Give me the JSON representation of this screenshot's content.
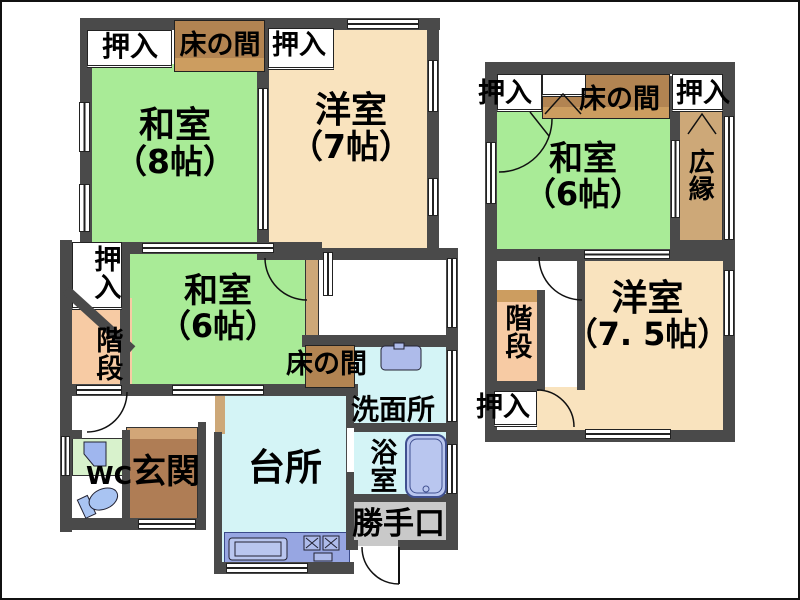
{
  "colors": {
    "wall": "#4A4A4A",
    "tatami_green": "#A9EB97",
    "western_beige": "#F9E3BE",
    "water_cyan": "#D4F4F6",
    "tokonoma_brown_dark": "#B28452",
    "tokonoma_brown_light": "#CC9D60",
    "genkan_brown": "#AF7D55",
    "stairs_peach": "#F7CBA4",
    "veranda_tan": "#CDA878",
    "backdoor_gray": "#C9C9C9",
    "counter_blue": "#97A6E2",
    "fixture_blue": "#B9C6EF"
  },
  "floor1": {
    "closet_top_left": "押入",
    "tokonoma_top": "床の間",
    "closet_top_right": "押入",
    "washitsu8_name": "和室",
    "washitsu8_size": "（8帖）",
    "yoshitsu7_name": "洋室",
    "yoshitsu7_size": "（7帖）",
    "closet_left": "押入",
    "stairs": "階段",
    "washitsu6_name": "和室",
    "washitsu6_size": "（6帖）",
    "tokonoma_mid": "床の間",
    "senmenjo": "洗面所",
    "wc": "WC",
    "genkan": "玄関",
    "daidokoro": "台所",
    "yokushitsu": "浴室",
    "katteguchi": "勝手口"
  },
  "floor2": {
    "closet_top_left": "押入",
    "tokonoma": "床の間",
    "closet_top_right": "押入",
    "washitsu6_name": "和室",
    "washitsu6_size": "（6帖）",
    "hiroen": "広縁",
    "stairs": "階段",
    "yoshitsu75_name": "洋室",
    "yoshitsu75_size": "（7. 5帖）",
    "closet_bottom": "押入"
  }
}
